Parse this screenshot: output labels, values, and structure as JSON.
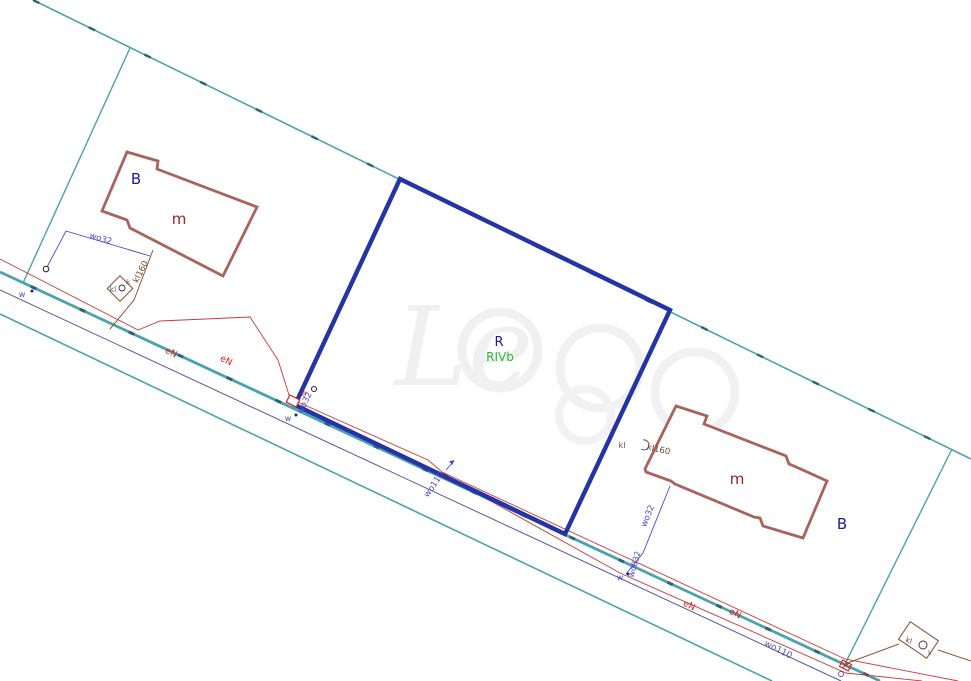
{
  "labels": {
    "landuse_left": "B",
    "building_left": "m",
    "landuse_right": "B",
    "building_right": "m",
    "parcel_class": "R",
    "soil_class": "RIVb",
    "water_main_center": "wo110",
    "water_main_right": "wo110",
    "water_service_left": "wo32",
    "water_service_corner": "wo32",
    "water_service_right": "wo32",
    "water_service_right_small": "wo032",
    "water_valve_left": "w",
    "water_valve_corner": "w",
    "water_valve_right": "w",
    "power_line_left_1": "eN",
    "power_line_left_2": "eN",
    "power_line_right_1": "eN",
    "power_line_right_2": "eN",
    "power_box": "e",
    "sewer_line_left": "kl160",
    "sewer_right_prefix": "kl",
    "sewer_line_right": "kl160",
    "sewer_box_left_text": "kl",
    "sewer_box_left_sub": "k",
    "sewer_box_right_text": "kl",
    "sewer_box_right_sub": "k"
  },
  "colors": {
    "boundary_teal": "#4aa2ae",
    "boundary_dash": "#2f6276",
    "parcel_blue": "#2433a6",
    "building_brown": "#a8635b",
    "power_red": "#cc3a3a",
    "water_blue": "#4a4ad0",
    "water_main_purple": "#5b55a0",
    "sewer_brown": "#8a5a3a",
    "label_navy": "#1b1b9e",
    "label_darkred": "#9b2222",
    "label_green": "#2eb82e",
    "label_red": "#cc2222",
    "watermark_gray": "#f0f0f0"
  }
}
